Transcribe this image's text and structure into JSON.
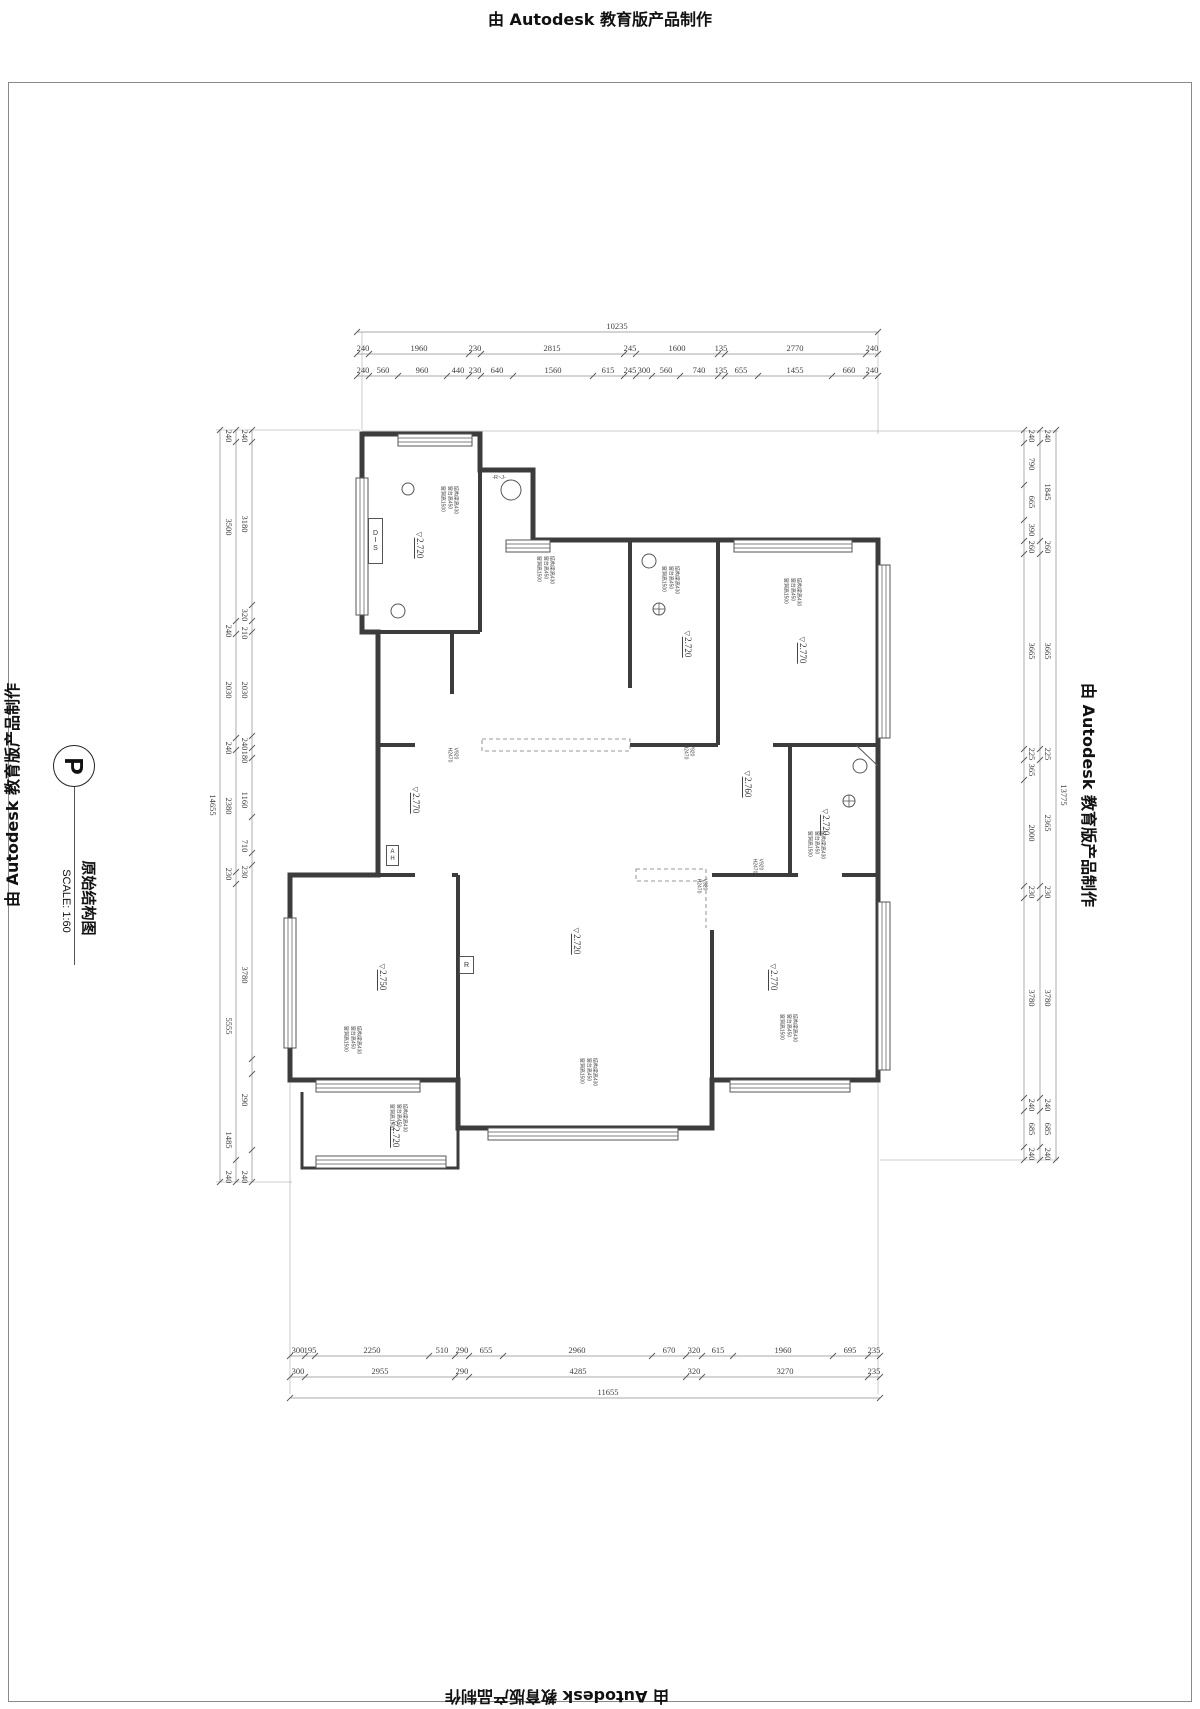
{
  "watermark": {
    "text": "由 Autodesk 教育版产品制作"
  },
  "title_block": {
    "badge": "P",
    "title": "原始结构图",
    "scale": "SCALE: 1:60"
  },
  "dimensions": {
    "top": {
      "rows": [
        {
          "o": "h",
          "p": 332,
          "s": [
            357,
            878
          ],
          "lo": -11,
          "t": [
            357,
            878
          ],
          "l": [
            [
              "10235",
              617
            ]
          ]
        },
        {
          "o": "h",
          "p": 354,
          "s": [
            357,
            878
          ],
          "lo": -11,
          "t": [
            357,
            369,
            469,
            481,
            624,
            636,
            718,
            725,
            866,
            878
          ],
          "l": [
            [
              "240",
              363
            ],
            [
              "1960",
              419
            ],
            [
              "230",
              475
            ],
            [
              "2815",
              552
            ],
            [
              "245",
              630
            ],
            [
              "1600",
              677
            ],
            [
              "135",
              721
            ],
            [
              "2770",
              795
            ],
            [
              "240",
              872
            ]
          ]
        },
        {
          "o": "h",
          "p": 376,
          "s": [
            357,
            878
          ],
          "lo": -11,
          "t": [
            357,
            369,
            398,
            447,
            469,
            481,
            513,
            593,
            624,
            636,
            652,
            680,
            718,
            725,
            758,
            832,
            866,
            878
          ],
          "l": [
            [
              "240",
              363
            ],
            [
              "560",
              383
            ],
            [
              "960",
              422
            ],
            [
              "440",
              458
            ],
            [
              "230",
              475
            ],
            [
              "640",
              497
            ],
            [
              "1560",
              553
            ],
            [
              "615",
              608
            ],
            [
              "245",
              630
            ],
            [
              "300",
              644
            ],
            [
              "560",
              666
            ],
            [
              "740",
              699
            ],
            [
              "135",
              721
            ],
            [
              "655",
              741
            ],
            [
              "1455",
              795
            ],
            [
              "660",
              849
            ],
            [
              "240",
              872
            ]
          ]
        }
      ]
    },
    "bottom": {
      "rows": [
        {
          "o": "h",
          "p": 1356,
          "s": [
            290,
            880
          ],
          "lo": -11,
          "t": [
            290,
            305,
            315,
            429,
            455,
            469,
            503,
            652,
            686,
            702,
            733,
            833,
            868,
            880
          ],
          "l": [
            [
              "300",
              298
            ],
            [
              "195",
              310
            ],
            [
              "2250",
              372
            ],
            [
              "510",
              442
            ],
            [
              "290",
              462
            ],
            [
              "655",
              486
            ],
            [
              "2960",
              577
            ],
            [
              "670",
              669
            ],
            [
              "320",
              694
            ],
            [
              "615",
              718
            ],
            [
              "1960",
              783
            ],
            [
              "695",
              850
            ],
            [
              "235",
              874
            ]
          ]
        },
        {
          "o": "h",
          "p": 1377,
          "s": [
            290,
            880
          ],
          "lo": -11,
          "t": [
            290,
            305,
            455,
            469,
            686,
            702,
            868,
            880
          ],
          "l": [
            [
              "300",
              298
            ],
            [
              "2955",
              380
            ],
            [
              "290",
              462
            ],
            [
              "4285",
              578
            ],
            [
              "320",
              694
            ],
            [
              "3270",
              785
            ],
            [
              "235",
              874
            ]
          ]
        },
        {
          "o": "h",
          "p": 1398,
          "s": [
            290,
            880
          ],
          "lo": -11,
          "t": [
            290,
            880
          ],
          "l": [
            [
              "11655",
              608
            ]
          ]
        }
      ]
    },
    "left": {
      "rows": [
        {
          "o": "v",
          "p": 252,
          "s": [
            430,
            1182
          ],
          "lo": -7,
          "t": [
            430,
            442,
            605,
            621,
            632,
            736,
            748,
            758,
            817,
            853,
            865,
            1059,
            1074,
            1150,
            1182
          ],
          "l": [
            [
              "240",
              436
            ],
            [
              "3180",
              524
            ],
            [
              "320",
              615
            ],
            [
              "210",
              633
            ],
            [
              "2030",
              690
            ],
            [
              "240",
              744
            ],
            [
              "180",
              757
            ],
            [
              "1160",
              800
            ],
            [
              "710",
              846
            ],
            [
              "230",
              872
            ],
            [
              "3780",
              975
            ],
            [
              "290",
              1100
            ],
            [
              "240",
              1177
            ]
          ]
        },
        {
          "o": "v",
          "p": 236,
          "s": [
            430,
            1182
          ],
          "lo": -7,
          "t": [
            430,
            442,
            621,
            634,
            738,
            750,
            872,
            884,
            1160,
            1182
          ],
          "l": [
            [
              "240",
              436
            ],
            [
              "3500",
              527
            ],
            [
              "240",
              631
            ],
            [
              "2030",
              690
            ],
            [
              "240",
              748
            ],
            [
              "2380",
              806
            ],
            [
              "230",
              874
            ],
            [
              "5555",
              1026
            ],
            [
              "1485",
              1140
            ],
            [
              "240",
              1177
            ]
          ]
        },
        {
          "o": "v",
          "p": 220,
          "s": [
            430,
            1182
          ],
          "lo": -7,
          "t": [
            430,
            1182
          ],
          "l": [
            [
              "14655",
              805
            ]
          ]
        }
      ]
    },
    "right": {
      "rows": [
        {
          "o": "v",
          "p": 1024,
          "s": [
            430,
            1160
          ],
          "lo": 8,
          "t": [
            430,
            443,
            485,
            520,
            541,
            554,
            749,
            760,
            780,
            886,
            898,
            1098,
            1111,
            1147,
            1160
          ],
          "l": [
            [
              "240",
              436
            ],
            [
              "790",
              464
            ],
            [
              "665",
              502
            ],
            [
              "390",
              530
            ],
            [
              "260",
              547
            ],
            [
              "3665",
              651
            ],
            [
              "225",
              754
            ],
            [
              "365",
              770
            ],
            [
              "2000",
              833
            ],
            [
              "230",
              892
            ],
            [
              "3780",
              998
            ],
            [
              "240",
              1105
            ],
            [
              "685",
              1129
            ],
            [
              "240",
              1154
            ]
          ]
        },
        {
          "o": "v",
          "p": 1040,
          "s": [
            430,
            1160
          ],
          "lo": 8,
          "t": [
            430,
            443,
            541,
            554,
            749,
            760,
            886,
            898,
            1098,
            1111,
            1147,
            1160
          ],
          "l": [
            [
              "240",
              436
            ],
            [
              "1845",
              492
            ],
            [
              "260",
              547
            ],
            [
              "3665",
              651
            ],
            [
              "225",
              754
            ],
            [
              "2365",
              823
            ],
            [
              "230",
              892
            ],
            [
              "3780",
              998
            ],
            [
              "240",
              1105
            ],
            [
              "685",
              1129
            ],
            [
              "240",
              1154
            ]
          ]
        },
        {
          "o": "v",
          "p": 1056,
          "s": [
            430,
            1160
          ],
          "lo": 8,
          "t": [
            430,
            1160
          ],
          "l": [
            [
              "13775",
              795
            ]
          ]
        }
      ]
    }
  },
  "levels": [
    {
      "t": "2.720",
      "x": 420,
      "y": 545
    },
    {
      "t": "2.720",
      "x": 688,
      "y": 644
    },
    {
      "t": "2.770",
      "x": 803,
      "y": 650
    },
    {
      "t": "2.760",
      "x": 748,
      "y": 784
    },
    {
      "t": "2.720",
      "x": 826,
      "y": 822
    },
    {
      "t": "2.770",
      "x": 416,
      "y": 800
    },
    {
      "t": "2.720",
      "x": 577,
      "y": 941
    },
    {
      "t": "2.770",
      "x": 774,
      "y": 977
    },
    {
      "t": "2.750",
      "x": 383,
      "y": 977
    },
    {
      "t": "2.720",
      "x": 396,
      "y": 1134
    }
  ],
  "annotations": [
    {
      "x": 449,
      "y": 500,
      "lines": [
        "结构梁高430",
        "窗台高450",
        "窗洞高1500"
      ]
    },
    {
      "x": 545,
      "y": 570,
      "lines": [
        "结构梁高430",
        "窗台高450",
        "窗洞高1500"
      ]
    },
    {
      "x": 670,
      "y": 580,
      "lines": [
        "结构梁高430",
        "窗台高450",
        "窗洞高1500"
      ]
    },
    {
      "x": 792,
      "y": 592,
      "lines": [
        "结构梁高430",
        "窗台高450",
        "窗洞高1500"
      ]
    },
    {
      "x": 816,
      "y": 845,
      "lines": [
        "结构梁高430",
        "窗台高450",
        "窗洞高1500"
      ]
    },
    {
      "x": 788,
      "y": 1028,
      "lines": [
        "结构梁高430",
        "窗台高450",
        "窗洞高1500"
      ]
    },
    {
      "x": 352,
      "y": 1040,
      "lines": [
        "结构梁高430",
        "窗台高450",
        "窗洞高1500"
      ]
    },
    {
      "x": 398,
      "y": 1118,
      "lines": [
        "结构梁高430",
        "窗台高450",
        "窗洞高1500"
      ]
    },
    {
      "x": 588,
      "y": 1072,
      "lines": [
        "结构梁高430",
        "窗台高450",
        "窗洞高1500"
      ]
    }
  ],
  "opening_notes": [
    {
      "x": 452,
      "y": 755,
      "lines": [
        "V920",
        "H2470"
      ]
    },
    {
      "x": 688,
      "y": 752,
      "lines": [
        "V920",
        "H2470"
      ]
    },
    {
      "x": 757,
      "y": 866,
      "lines": [
        "V920",
        "H2470"
      ]
    },
    {
      "x": 701,
      "y": 886,
      "lines": [
        "V920",
        "H2470"
      ]
    }
  ],
  "misc_labels": {
    "dis": {
      "t": "DIS",
      "x": 368,
      "y": 518,
      "w": 13,
      "h": 44
    },
    "ah": {
      "t": "AH",
      "x": 386,
      "y": 845,
      "w": 11,
      "h": 19
    },
    "r": {
      "t": "R",
      "x": 459,
      "y": 956,
      "w": 13,
      "h": 16
    },
    "rj": {
      "t": "-R~J-",
      "x": 499,
      "y": 478
    }
  },
  "plan_geometry": {
    "walls": [
      {
        "d": "M362,434 L480,434 L480,470 L533,470 L533,540 L878,540 L878,1080 L712,1080 L712,1128 L458,1128 L458,1080 L290,1080 L290,875 L378,875 L378,632 L362,632 Z",
        "w": 5
      },
      {
        "d": "M362,632 L480,632",
        "w": 4
      },
      {
        "d": "M480,470 L480,632",
        "w": 4
      },
      {
        "d": "M452,632 L452,694",
        "w": 4
      },
      {
        "d": "M378,745 L415,745",
        "w": 4
      },
      {
        "d": "M630,540 L630,688",
        "w": 4
      },
      {
        "d": "M630,745 L718,745",
        "w": 4
      },
      {
        "d": "M718,540 L718,745",
        "w": 4
      },
      {
        "d": "M773,745 L878,745",
        "w": 4
      },
      {
        "d": "M790,745 L790,875",
        "w": 4
      },
      {
        "d": "M712,875 L798,875",
        "w": 4
      },
      {
        "d": "M842,875 L878,875",
        "w": 4
      },
      {
        "d": "M712,930 L712,1080",
        "w": 4
      },
      {
        "d": "M458,875 L458,1080",
        "w": 4
      },
      {
        "d": "M378,875 L415,875",
        "w": 4
      },
      {
        "d": "M452,875 L458,875",
        "w": 4
      },
      {
        "d": "M302,1092 L302,1168 L458,1168 L458,1092",
        "w": 3
      }
    ],
    "windows": [
      [
        398,
        434,
        74,
        12
      ],
      [
        506,
        540,
        44,
        12
      ],
      [
        734,
        540,
        118,
        12
      ],
      [
        878,
        565,
        12,
        173
      ],
      [
        878,
        902,
        12,
        168
      ],
      [
        730,
        1080,
        120,
        12
      ],
      [
        488,
        1128,
        190,
        12
      ],
      [
        316,
        1080,
        104,
        12
      ],
      [
        316,
        1156,
        130,
        12
      ],
      [
        356,
        478,
        12,
        137
      ],
      [
        284,
        918,
        12,
        130
      ]
    ],
    "circles": [
      [
        408,
        489,
        6
      ],
      [
        511,
        490,
        10
      ],
      [
        398,
        611,
        7
      ],
      [
        649,
        561,
        7
      ],
      [
        860,
        766,
        7
      ]
    ],
    "cross_circles": [
      [
        659,
        609,
        6
      ],
      [
        849,
        801,
        6
      ]
    ],
    "extra_lines": [
      [
        856,
        745,
        878,
        766
      ]
    ],
    "dashed_rects": [
      [
        482,
        739,
        148,
        12
      ],
      [
        636,
        869,
        70,
        12
      ]
    ],
    "dashed_lines": [
      [
        706,
        883,
        706,
        928
      ]
    ],
    "extension_lines": [
      [
        362,
        332,
        362,
        430
      ],
      [
        878,
        332,
        878,
        434
      ],
      [
        290,
        1082,
        290,
        1394
      ],
      [
        878,
        1082,
        878,
        1394
      ],
      [
        216,
        430,
        360,
        430
      ],
      [
        216,
        1182,
        292,
        1182
      ],
      [
        362,
        431,
        1058,
        431
      ],
      [
        880,
        1160,
        1058,
        1160
      ]
    ]
  }
}
